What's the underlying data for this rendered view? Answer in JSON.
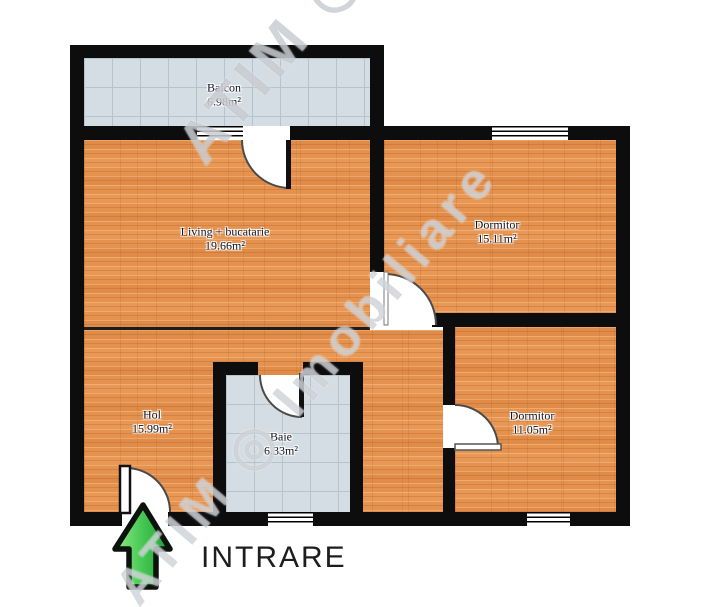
{
  "plan": {
    "watermark": "ATIM ◎ Imobiliare",
    "entrance": {
      "label": "INTRARE"
    },
    "rooms": [
      {
        "id": "balcon",
        "name": "Balcon",
        "area": "6.98m²"
      },
      {
        "id": "living",
        "name": "Living + bucatarie",
        "area": "19.66m²"
      },
      {
        "id": "dormitor-1",
        "name": "Dormitor",
        "area": "15.11m²"
      },
      {
        "id": "hol",
        "name": "Hol",
        "area": "15.99m²"
      },
      {
        "id": "baie",
        "name": "Baie",
        "area": "6.33m²"
      },
      {
        "id": "dormitor-2",
        "name": "Dormitor",
        "area": "11.05m²"
      }
    ],
    "colors": {
      "wall": "#0d0d0d",
      "wood_floor": "#e5924f",
      "tile_floor": "#d4dde3",
      "arrow_green": "#3dbb4a",
      "label_text": "#141420"
    }
  }
}
